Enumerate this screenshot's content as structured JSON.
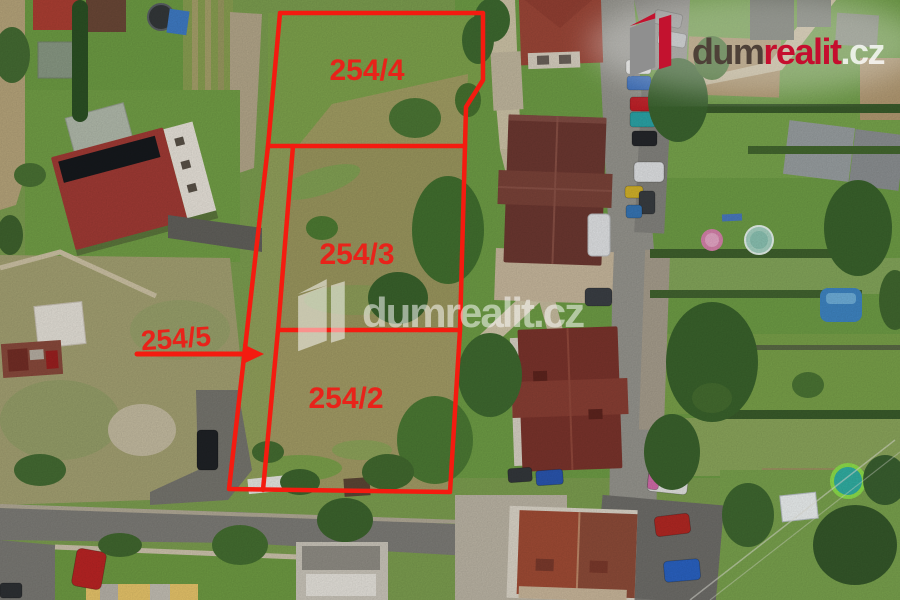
{
  "scene": {
    "description": "Aerial drone photo of grassy building plots for sale, outlined in red, surrounded by houses, gardens, pools and streets"
  },
  "annotations": {
    "accent_color": "#f41b10",
    "label_color": "#e8231a",
    "parcels": [
      {
        "label": "254/4"
      },
      {
        "label": "254/3"
      },
      {
        "label": "254/2"
      }
    ],
    "arrow_parcel": {
      "label": "254/5"
    }
  },
  "branding": {
    "logo": {
      "part_dark": "dum",
      "part_red": "realit",
      "part_suffix": ".cz",
      "dark_color": "#4e4138",
      "red_color": "#c50e2e",
      "suffix_color": "rgba(255,255,255,0.8)",
      "icon_gray": "#8f8f8f",
      "icon_red": "#c3122f"
    },
    "watermark": {
      "text": "dumrealit.cz",
      "color": "#ffffff"
    }
  }
}
